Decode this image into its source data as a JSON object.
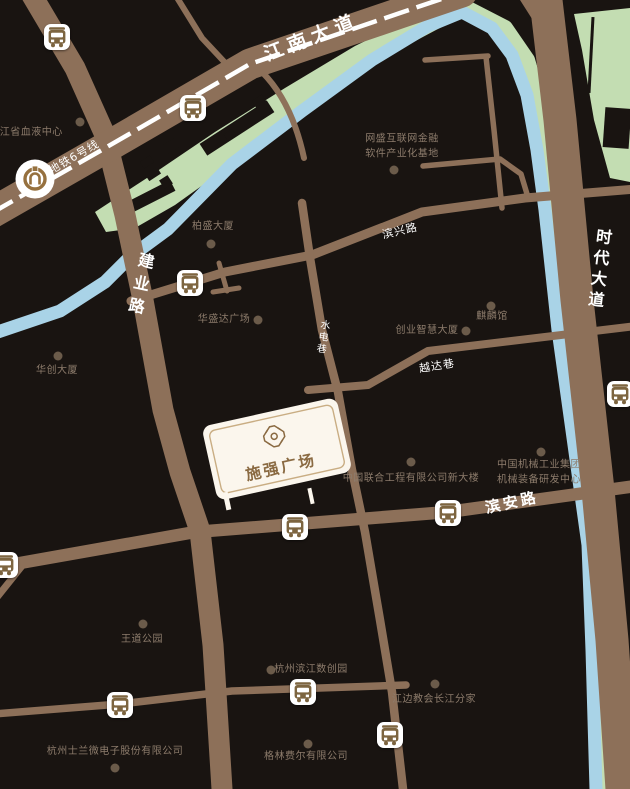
{
  "map": {
    "plaza": {
      "name": "施强广场"
    },
    "colors": {
      "background": "#191411",
      "road": "#8d7059",
      "river": "#a9d3e7",
      "park_green": "#c3ddb2",
      "poi_text": "#8d7c6c",
      "poi_dot": "#6b5b4a",
      "road_label": "#ffffff",
      "plaza_fill": "#fbf6ed",
      "plaza_accent": "#8a6a42",
      "bus_glyph": "#7d6540",
      "metro_logo": "#96713f"
    },
    "road_labels": [
      {
        "text": "江南大道",
        "x": 312,
        "y": 38,
        "rotate": -21,
        "size": 19,
        "bold": true,
        "spacing": 6,
        "vertical": false
      },
      {
        "text": "地铁6号线",
        "x": 74,
        "y": 157,
        "rotate": -30,
        "size": 11,
        "bold": false,
        "spacing": 1,
        "vertical": false
      },
      {
        "text": "建业路",
        "x": 139,
        "y": 286,
        "rotate": 12,
        "size": 16,
        "bold": true,
        "spacing": 7,
        "vertical": true
      },
      {
        "text": "滨兴路",
        "x": 400,
        "y": 231,
        "rotate": -13,
        "size": 11,
        "bold": false,
        "spacing": 1,
        "vertical": false
      },
      {
        "text": "水电巷",
        "x": 321,
        "y": 337,
        "rotate": 9,
        "size": 10,
        "bold": false,
        "spacing": 2,
        "vertical": true
      },
      {
        "text": "越达巷",
        "x": 437,
        "y": 366,
        "rotate": -9,
        "size": 11,
        "bold": false,
        "spacing": 1,
        "vertical": false
      },
      {
        "text": "滨安路",
        "x": 512,
        "y": 503,
        "rotate": -12,
        "size": 15,
        "bold": true,
        "spacing": 3,
        "vertical": false
      },
      {
        "text": "时代大道",
        "x": 598,
        "y": 270,
        "rotate": 7,
        "size": 16,
        "bold": true,
        "spacing": 5,
        "vertical": true
      }
    ],
    "pois": [
      {
        "text": "浙江省血液中心",
        "x": 26,
        "y": 133,
        "dot_x": 80,
        "dot_y": 122
      },
      {
        "text": "网盛互联网金融\n软件产业化基地",
        "x": 402,
        "y": 147,
        "dot_x": 394,
        "dot_y": 170
      },
      {
        "text": "柏盛大厦",
        "x": 213,
        "y": 227,
        "dot_x": 211,
        "dot_y": 244
      },
      {
        "text": "华盛达广场",
        "x": 224,
        "y": 320,
        "dot_x": 258,
        "dot_y": 320
      },
      {
        "text": "麒麟馆",
        "x": 492,
        "y": 317,
        "dot_x": 491,
        "dot_y": 306
      },
      {
        "text": "创业智慧大厦",
        "x": 427,
        "y": 331,
        "dot_x": 466,
        "dot_y": 331
      },
      {
        "text": "华创大厦",
        "x": 57,
        "y": 371,
        "dot_x": 58,
        "dot_y": 356
      },
      {
        "text": "中国联合工程有限公司新大楼",
        "x": 411,
        "y": 479,
        "dot_x": 411,
        "dot_y": 462
      },
      {
        "text": "中国机械工业集团\n机械装备研发中心",
        "x": 539,
        "y": 473,
        "dot_x": 541,
        "dot_y": 452
      },
      {
        "text": "王道公园",
        "x": 142,
        "y": 640,
        "dot_x": 143,
        "dot_y": 624
      },
      {
        "text": "杭州滨江数创园",
        "x": 311,
        "y": 670,
        "dot_x": 271,
        "dot_y": 670
      },
      {
        "text": "江边教会长江分家",
        "x": 434,
        "y": 700,
        "dot_x": 435,
        "dot_y": 684
      },
      {
        "text": "格林费尔有限公司",
        "x": 306,
        "y": 757,
        "dot_x": 308,
        "dot_y": 744
      },
      {
        "text": "杭州士兰微电子股份有限公司",
        "x": 115,
        "y": 752,
        "dot_x": 115,
        "dot_y": 768
      }
    ],
    "bus_stops": [
      {
        "x": 57,
        "y": 37
      },
      {
        "x": 193,
        "y": 108
      },
      {
        "x": 190,
        "y": 283
      },
      {
        "x": 620,
        "y": 394
      },
      {
        "x": 295,
        "y": 527
      },
      {
        "x": 448,
        "y": 513
      },
      {
        "x": 5,
        "y": 565
      },
      {
        "x": 120,
        "y": 705
      },
      {
        "x": 303,
        "y": 692
      },
      {
        "x": 390,
        "y": 735
      }
    ],
    "metro_station": {
      "x": 35,
      "y": 179
    }
  }
}
